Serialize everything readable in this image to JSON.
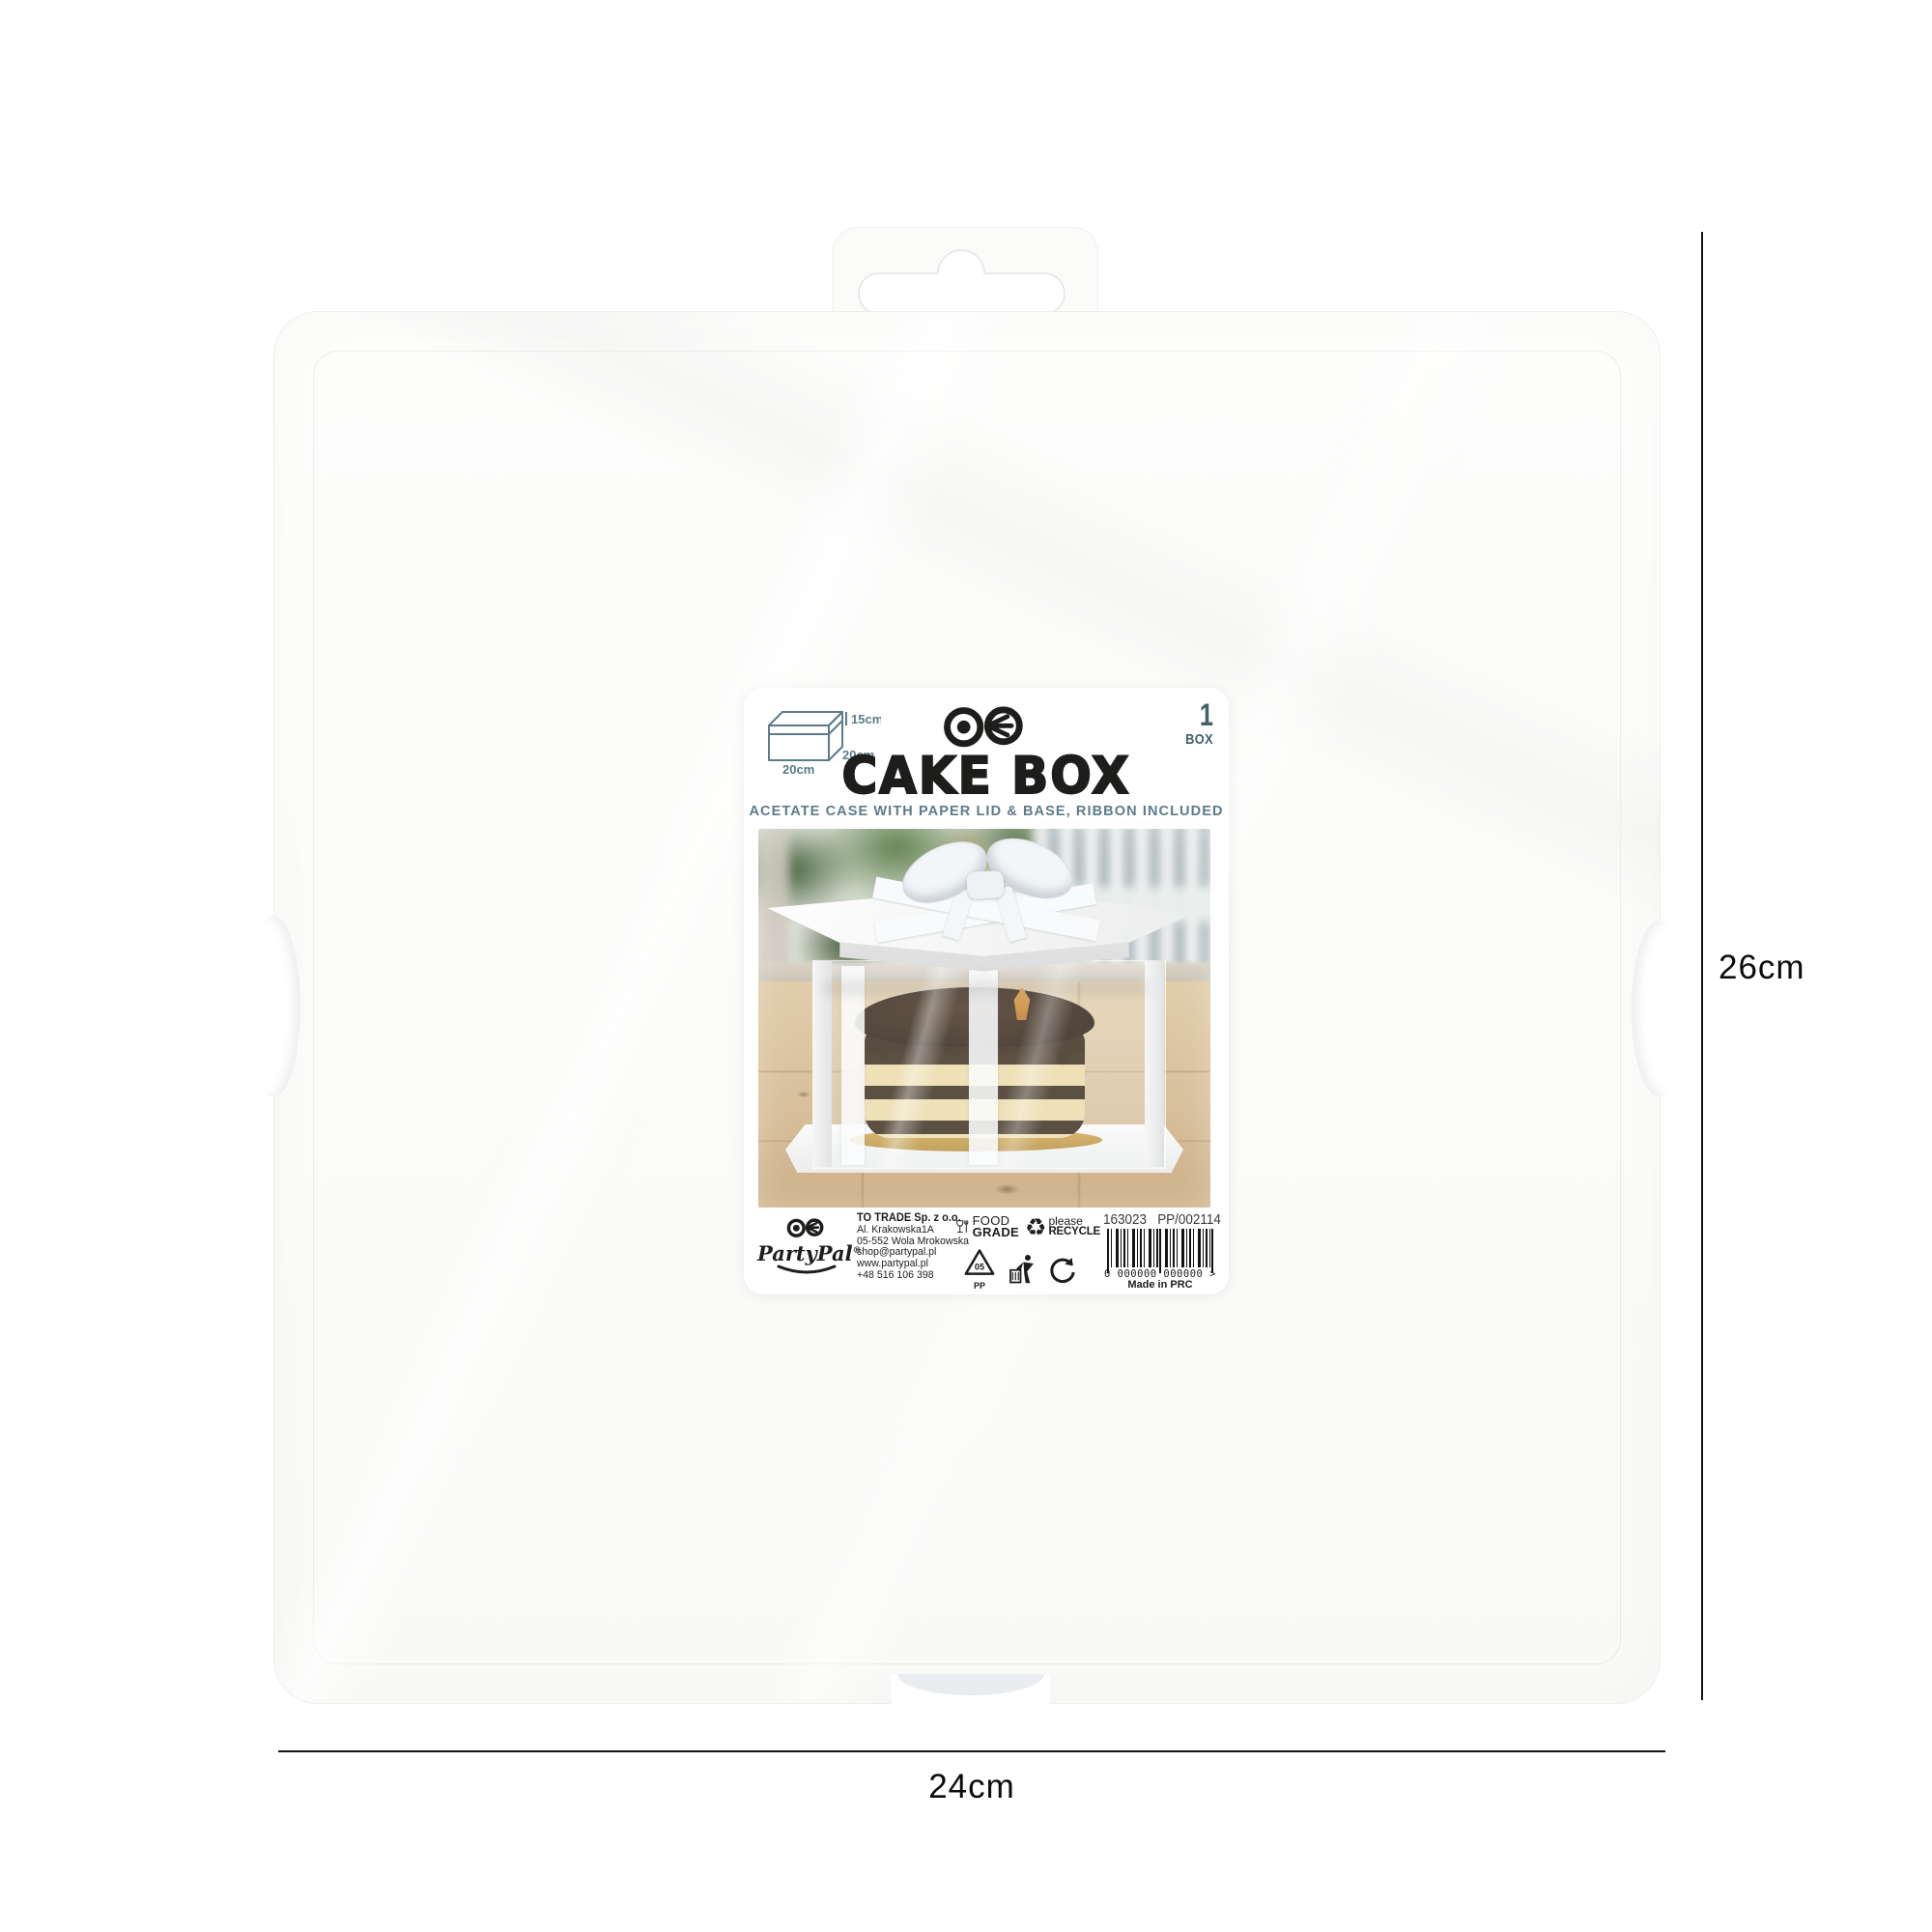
{
  "dimensions": {
    "height_label": "26cm",
    "width_label": "24cm"
  },
  "label": {
    "diagram": {
      "height": "15cm",
      "depth": "20cm",
      "width": "20cm"
    },
    "pack": {
      "count": "1",
      "unit": "BOX"
    },
    "product_name": "CAKE BOX",
    "subtitle": "ACETATE CASE WITH PAPER LID & BASE, RIBBON INCLUDED",
    "footer": {
      "brand": "PartyPal",
      "brand_reg": "®",
      "company": "TO TRADE Sp. z o.o.",
      "address": [
        "Al. Krakowska1A",
        "05-552 Wola Mrokowska",
        "shop@partypal.pl",
        "www.partypal.pl",
        "+48 516 106 398"
      ],
      "food_grade": {
        "line1": "FOOD",
        "line2": "GRADE"
      },
      "recycle": {
        "line1": "please",
        "line2": "RECYCLE",
        "glyph": "♻"
      },
      "pp_number": "05",
      "pp_label": "PP",
      "item_code": "163023",
      "item_ref": "PP/002114",
      "barcode_digits": "0 000000 000000 >",
      "made_in": "Made in PRC"
    }
  },
  "colors": {
    "accent_slate": "#5d7b8a",
    "ink": "#1d1d1b"
  }
}
